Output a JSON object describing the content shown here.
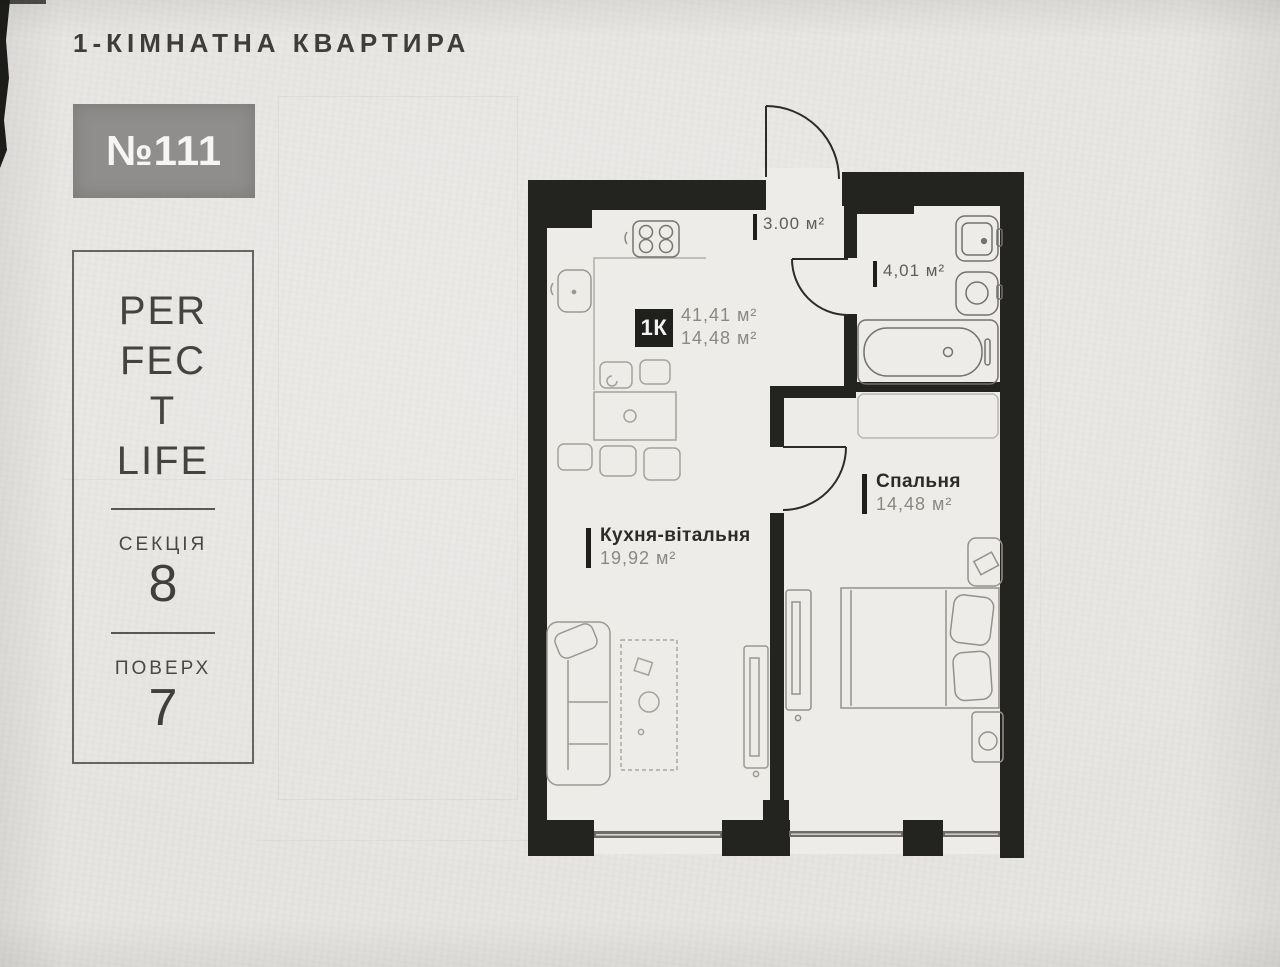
{
  "header": {
    "title": "1-КІМНАТНА КВАРТИРА"
  },
  "unit_badge": {
    "number": "№111"
  },
  "info_panel": {
    "logo_line1": "PER",
    "logo_line2": "FEC",
    "logo_line3": "T",
    "logo_line4": "LIFE",
    "section_label": "СЕКЦІЯ",
    "section_value": "8",
    "floor_label": "ПОВЕРХ",
    "floor_value": "7"
  },
  "plan": {
    "unit_type_badge": "1К",
    "total_area": "41,41 м²",
    "living_area": "14,48 м²",
    "rooms": {
      "hallway": {
        "area": "3.00 м²"
      },
      "bathroom": {
        "area": "4,01 м²"
      },
      "kitchen_living": {
        "name": "Кухня-вітальня",
        "area": "19,92 м²"
      },
      "bedroom": {
        "name": "Спальня",
        "area": "14,48 м²"
      }
    }
  },
  "colors": {
    "paper": "#e7e5e2",
    "wall": "#232320",
    "badge_gray": "#8f8e8c",
    "text_dark": "#2c2b29",
    "text_gray": "#8b8883"
  }
}
